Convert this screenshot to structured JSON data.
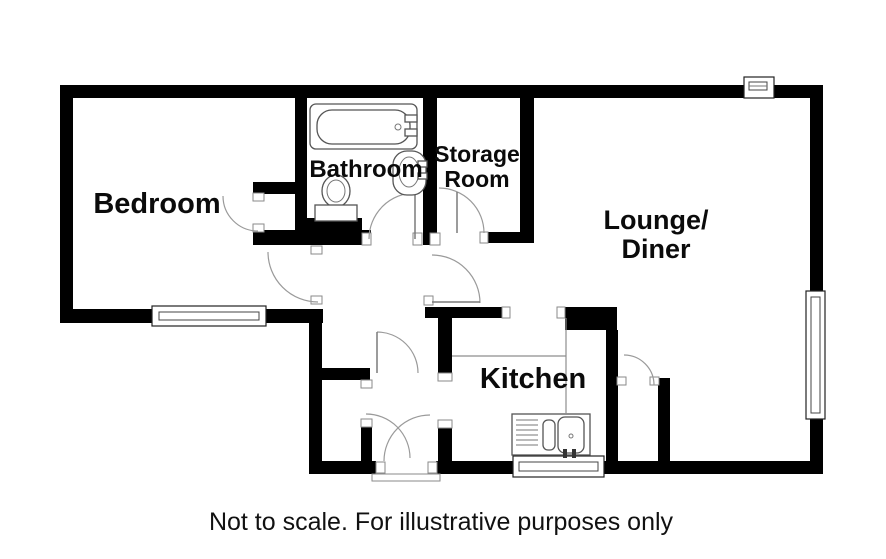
{
  "plan": {
    "rooms": {
      "bedroom": "Bedroom",
      "bathroom": "Bathroom",
      "storage_line1": "Storage",
      "storage_line2": "Room",
      "lounge_line1": "Lounge/",
      "lounge_line2": "Diner",
      "kitchen": "Kitchen"
    },
    "caption": "Not to scale. For illustrative purposes only",
    "colors": {
      "wall": "#000000",
      "background": "#ffffff",
      "door_arc": "#9a9a9a",
      "fixture_outline": "#555555"
    }
  }
}
